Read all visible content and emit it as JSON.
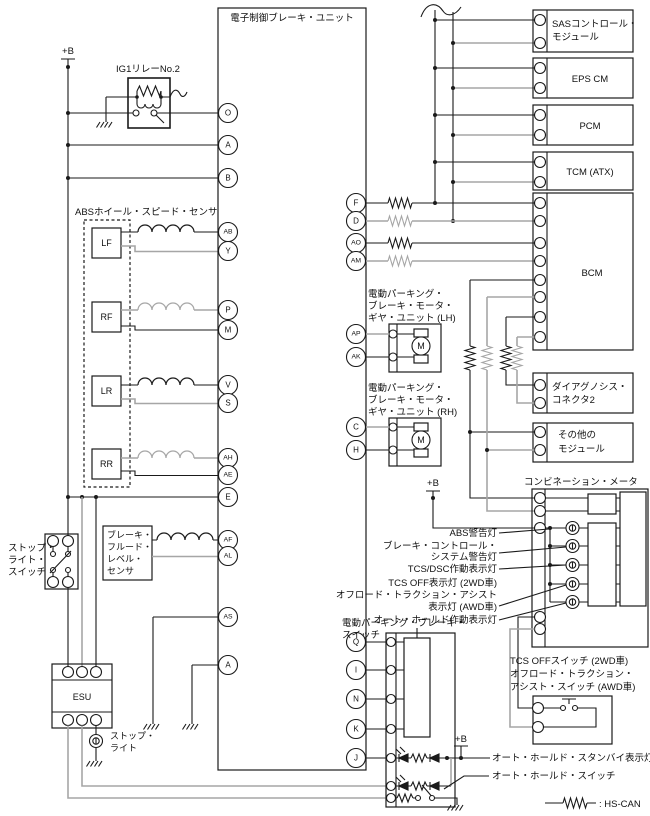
{
  "unit_title": "電子制御ブレーキ・ユニット",
  "plus_b": "+B",
  "relay_label": "IG1リレーNo.2",
  "abs_label": "ABSホイール・スピード・センサ",
  "sensors": [
    "LF",
    "RF",
    "LR",
    "RR"
  ],
  "terminals_left": [
    "O",
    "A",
    "B",
    "AB",
    "Y",
    "P",
    "M",
    "V",
    "S",
    "AH",
    "AE",
    "E",
    "AF",
    "AL",
    "AS",
    "A"
  ],
  "terminals_right": [
    "F",
    "D",
    "AO",
    "AM",
    "AP",
    "AK",
    "C",
    "H",
    "Q",
    "I",
    "N",
    "K",
    "J"
  ],
  "modules": {
    "sas": [
      "SASコントロール・",
      "モジュール"
    ],
    "eps": "EPS CM",
    "pcm": "PCM",
    "tcm": "TCM (ATX)",
    "bcm": "BCM",
    "diag": [
      "ダイアグノシス・",
      "コネクタ2"
    ],
    "other": [
      "その他の",
      "モジュール"
    ]
  },
  "meter": {
    "label": "コンビネーション・メータ",
    "lamp_abs": "ABS警告灯",
    "lamp_brake": [
      "ブレーキ・コントロール・",
      "システム警告灯"
    ],
    "lamp_tcs": "TCS/DSC作動表示灯",
    "lamp_tcsoff": [
      "TCS OFF表示灯 (2WD車)",
      "オフロード・トラクション・アシスト",
      "表示灯 (AWD車)"
    ],
    "lamp_autohold": "オート・ホールド作動表示灯"
  },
  "epb": {
    "lh": [
      "電動パーキング・",
      "ブレーキ・モータ・",
      "ギヤ・ユニット (LH)"
    ],
    "rh": [
      "電動パーキング・",
      "ブレーキ・モータ・",
      "ギヤ・ユニット (RH)"
    ],
    "sw": [
      "電動パーキング・ブレーキ・",
      "スイッチ"
    ],
    "motor_m": "M"
  },
  "tcs_sw": [
    "TCS OFFスイッチ (2WD車)",
    "オフロード・トラクション・",
    "アシスト・スイッチ (AWD車)"
  ],
  "autohold": {
    "standby": "オート・ホールド・スタンバイ表示灯",
    "switch": "オート・ホールド・スイッチ"
  },
  "stop_sw": [
    "ストップ・",
    "ライト・",
    "スイッチ"
  ],
  "fluid": [
    "ブレーキ・",
    "フルード・",
    "レベル・",
    "センサ"
  ],
  "esu": "ESU",
  "stop_lamp": [
    "ストップ・",
    "ライト"
  ],
  "legend_hs_can": ": HS-CAN",
  "colors": {
    "wire": "#1a1a1a",
    "wire_gray": "#a6a6a6",
    "background": "#ffffff"
  }
}
